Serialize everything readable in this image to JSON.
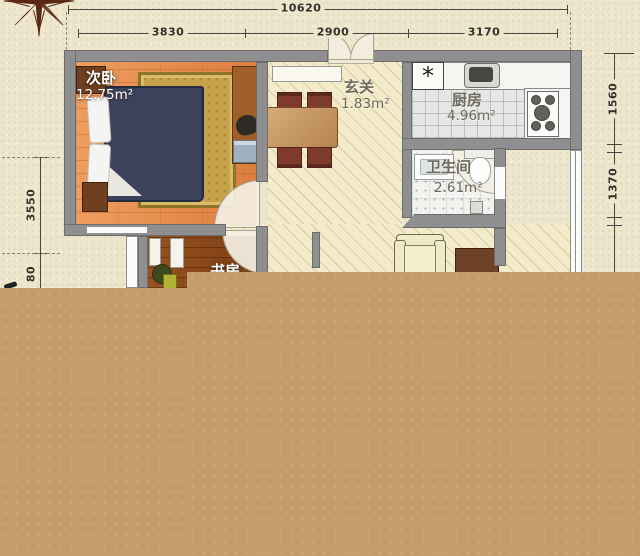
{
  "title": "apartment-floor-plan",
  "dimensions": {
    "top_total": "10620",
    "top_segments": [
      "3830",
      "2900",
      "3170"
    ],
    "left_segments": [
      "3550",
      "80"
    ],
    "right_segments": [
      "1560",
      "1370"
    ]
  },
  "rooms": {
    "bedroom": {
      "name": "次卧",
      "area": "12.75m²"
    },
    "hall": {
      "name": "玄关",
      "area": "1.83m²"
    },
    "kitchen": {
      "name": "厨房",
      "area": "4.96m²"
    },
    "bath": {
      "name": "卫生间",
      "area": "2.61m²"
    },
    "study": {
      "name": "书房"
    }
  },
  "icons": {
    "kitchen_appliance_symbol": "*"
  },
  "colors": {
    "page_background": "#EDE5CC",
    "cover_block": "#C49D6D",
    "wall_gray": "#8F8F8F",
    "bedroom_floor": "#E58B4F",
    "study_floor": "#8D4B20",
    "hall_floor": "#F4EBCB",
    "kitchen_floor": "#E5E7E4",
    "bed": "#3D425C",
    "rug": "#C6A24A",
    "dining_chair": "#7E3B2B",
    "label_white": "#FFFFFF",
    "label_gray": "#6E6A5F"
  }
}
